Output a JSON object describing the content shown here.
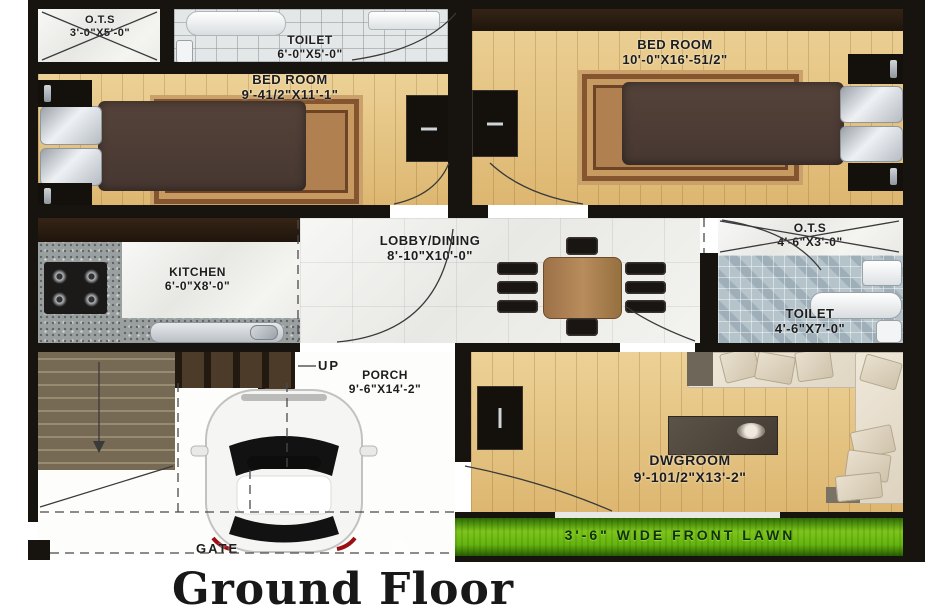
{
  "title": "Ground Floor",
  "watermark": "©",
  "rooms": {
    "ots_top": {
      "name": "O.T.S",
      "dims": "3'-0\"X5'-0\""
    },
    "toilet_top": {
      "name": "TOILET",
      "dims": "6'-0\"X5'-0\""
    },
    "bedroom_left": {
      "name": "BED ROOM",
      "dims": "9'-41/2\"X11'-1\""
    },
    "bedroom_right": {
      "name": "BED ROOM",
      "dims": "10'-0\"X16'-51/2\""
    },
    "kitchen": {
      "name": "KITCHEN",
      "dims": "6'-0\"X8'-0\""
    },
    "lobby": {
      "name": "LOBBY/DINING",
      "dims": "8'-10\"X10'-0\""
    },
    "ots_right": {
      "name": "O.T.S",
      "dims": "4'-6\"X3'-0\""
    },
    "toilet_right": {
      "name": "TOILET",
      "dims": "4'-6\"X7'-0\""
    },
    "porch": {
      "name": "PORCH",
      "dims": "9'-6\"X14'-2\""
    },
    "dwgroom": {
      "name": "DWGROOM",
      "dims": "9'-101/2\"X13'-2\""
    }
  },
  "labels": {
    "up": "UP",
    "gate": "GATE",
    "lawn": "3'-6\" WIDE FRONT LAWN"
  },
  "colors": {
    "wall": "#17130e",
    "wood_floor": "#e3c17f",
    "marble": "#f2f2f0",
    "granite_counter": "#9aa0a0",
    "toilet_mosaic": "#b5c3cb",
    "lawn_green": "#5fae0e",
    "rug": "#b08050"
  }
}
